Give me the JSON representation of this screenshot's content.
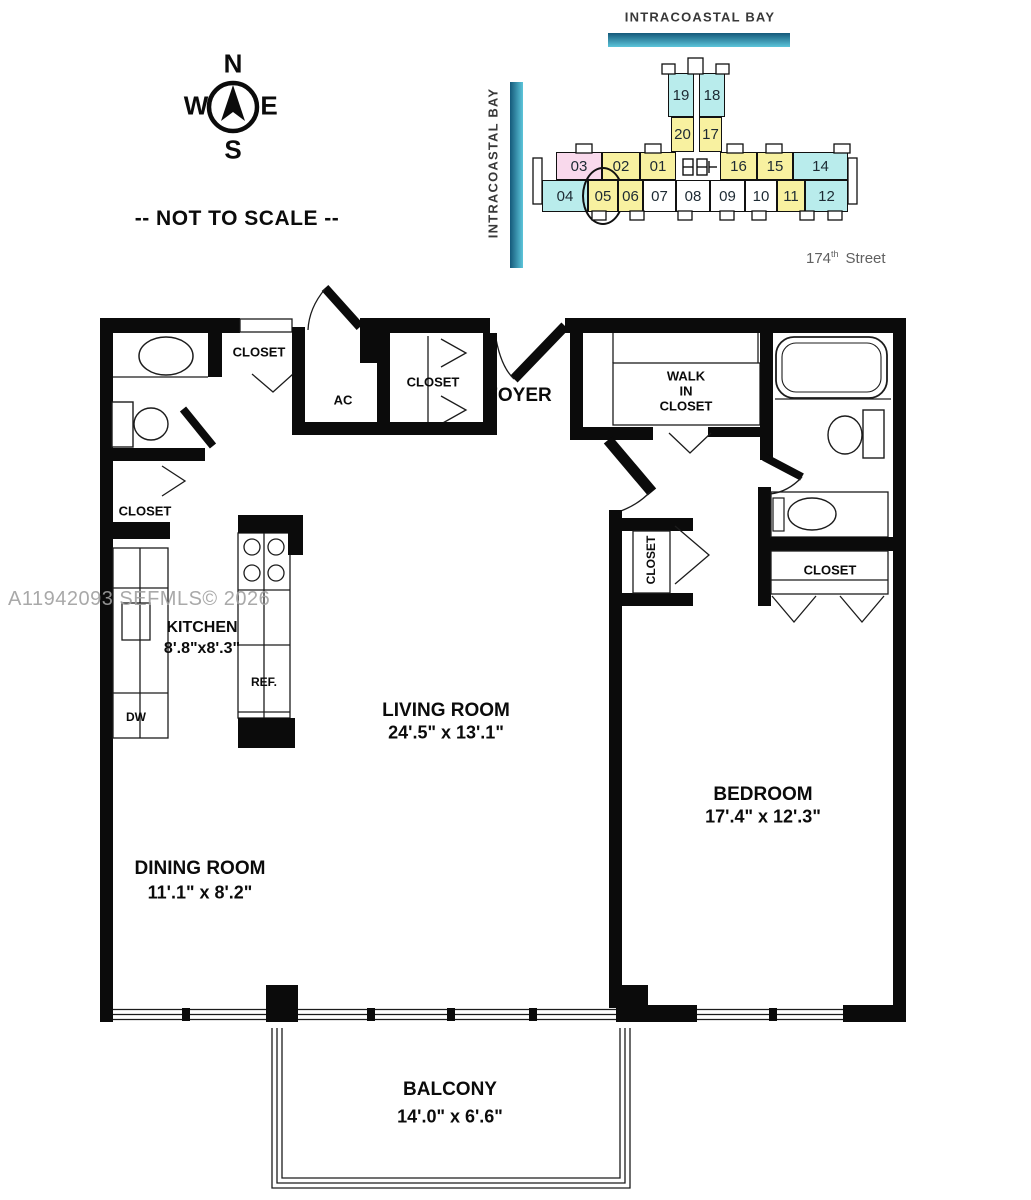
{
  "compass": {
    "n": "N",
    "s": "S",
    "e": "E",
    "w": "W"
  },
  "scale_note": "-- NOT TO SCALE --",
  "watermark": "A11942093 SEFMLS© 2026",
  "site_plan": {
    "bay_top": "INTRACOASTAL BAY",
    "bay_left": "INTRACOASTAL BAY",
    "street": {
      "number": "174",
      "sup": "th",
      "name": "Street"
    },
    "highlighted_unit": "05",
    "colors": {
      "cyan": "#b9ecec",
      "yellow": "#f8f1a0",
      "pink": "#f9d9ec",
      "white": "#ffffff",
      "bar_dark": "#14597a",
      "bar_light": "#5cc5da",
      "outline": "#111111"
    },
    "units": [
      {
        "label": "19",
        "color": "cyan",
        "x": 668,
        "y": 73,
        "w": 26,
        "h": 44
      },
      {
        "label": "18",
        "color": "cyan",
        "x": 699,
        "y": 73,
        "w": 26,
        "h": 44
      },
      {
        "label": "20",
        "color": "yellow",
        "x": 671,
        "y": 117,
        "w": 23,
        "h": 35
      },
      {
        "label": "17",
        "color": "yellow",
        "x": 699,
        "y": 117,
        "w": 23,
        "h": 35
      },
      {
        "label": "03",
        "color": "pink",
        "x": 556,
        "y": 152,
        "w": 46,
        "h": 28
      },
      {
        "label": "02",
        "color": "yellow",
        "x": 602,
        "y": 152,
        "w": 38,
        "h": 28
      },
      {
        "label": "01",
        "color": "yellow",
        "x": 640,
        "y": 152,
        "w": 36,
        "h": 28
      },
      {
        "label": "16",
        "color": "yellow",
        "x": 720,
        "y": 152,
        "w": 37,
        "h": 28
      },
      {
        "label": "15",
        "color": "yellow",
        "x": 757,
        "y": 152,
        "w": 36,
        "h": 28
      },
      {
        "label": "14",
        "color": "cyan",
        "x": 793,
        "y": 152,
        "w": 55,
        "h": 28
      },
      {
        "label": "04",
        "color": "cyan",
        "x": 542,
        "y": 180,
        "w": 46,
        "h": 32
      },
      {
        "label": "05",
        "color": "yellow",
        "x": 588,
        "y": 180,
        "w": 30,
        "h": 32,
        "circled": true
      },
      {
        "label": "06",
        "color": "yellow",
        "x": 618,
        "y": 180,
        "w": 25,
        "h": 32
      },
      {
        "label": "07",
        "color": "white",
        "x": 643,
        "y": 180,
        "w": 33,
        "h": 32
      },
      {
        "label": "08",
        "color": "white",
        "x": 676,
        "y": 180,
        "w": 34,
        "h": 32
      },
      {
        "label": "09",
        "color": "white",
        "x": 710,
        "y": 180,
        "w": 35,
        "h": 32
      },
      {
        "label": "10",
        "color": "white",
        "x": 745,
        "y": 180,
        "w": 32,
        "h": 32
      },
      {
        "label": "11",
        "color": "yellow",
        "x": 777,
        "y": 180,
        "w": 28,
        "h": 32
      },
      {
        "label": "12",
        "color": "cyan",
        "x": 805,
        "y": 180,
        "w": 43,
        "h": 32
      }
    ]
  },
  "floor_plan": {
    "rooms": {
      "living": {
        "name": "LIVING ROOM",
        "dims": "24'.5\" x 13'.1\""
      },
      "dining": {
        "name": "DINING ROOM",
        "dims": "11'.1\" x 8'.2\""
      },
      "bedroom": {
        "name": "BEDROOM",
        "dims": "17'.4\" x 12'.3\""
      },
      "kitchen": {
        "name": "KITCHEN",
        "dims": "8'.8\"x8'.3\""
      },
      "balcony": {
        "name": "BALCONY",
        "dims": "14'.0\" x 6'.6\""
      },
      "foyer": {
        "name": "FOYER"
      }
    },
    "labels": {
      "closet": "CLOSET",
      "walk_in_1": "WALK",
      "walk_in_2": "IN",
      "walk_in_3": "CLOSET",
      "ac": "AC",
      "ref": "REF.",
      "dw": "DW"
    }
  }
}
